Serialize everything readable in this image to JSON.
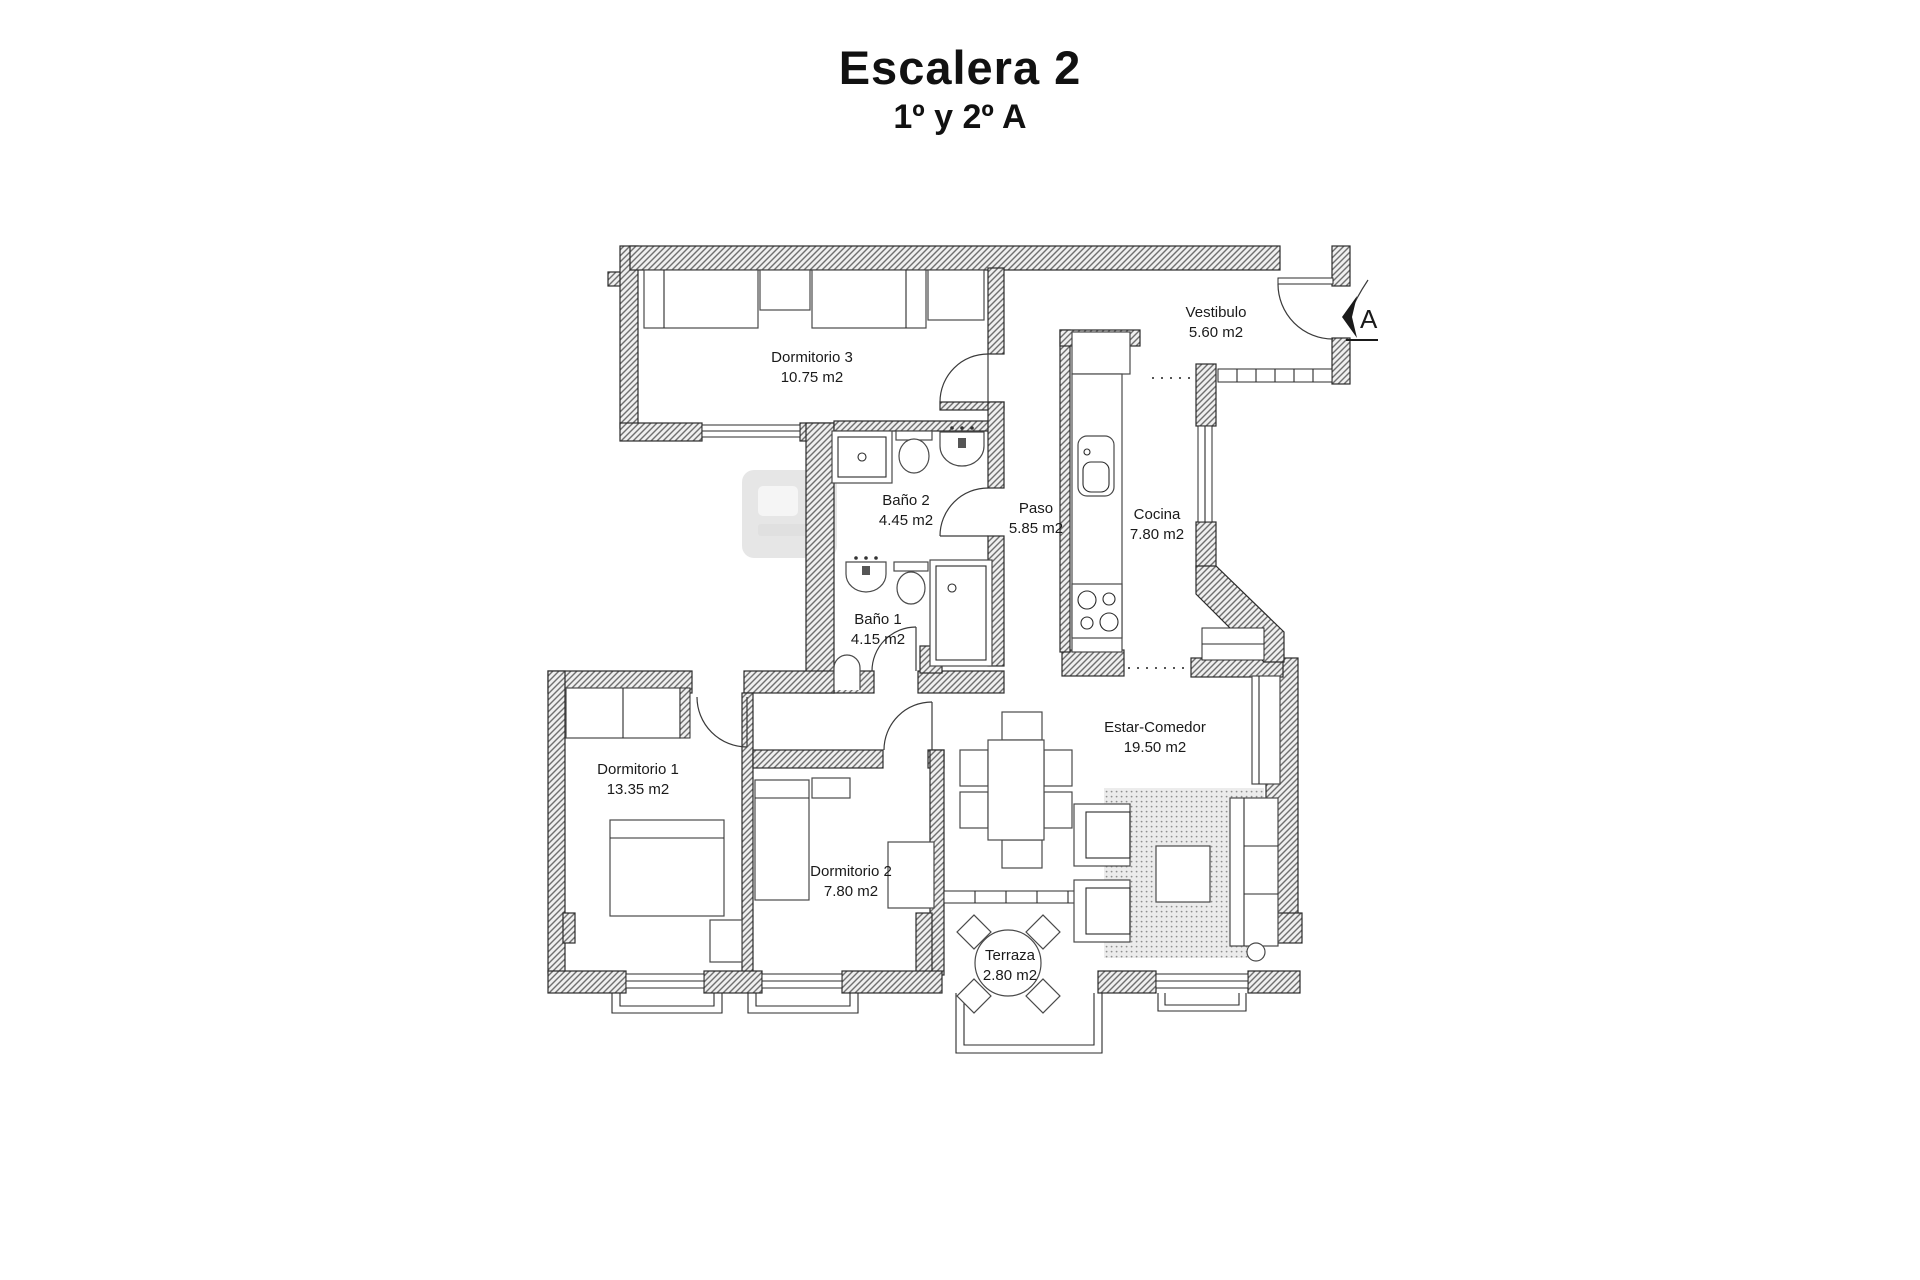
{
  "header": {
    "title": "Escalera 2",
    "subtitle": "1º y 2º A"
  },
  "rooms": [
    {
      "id": "dormitorio-3",
      "name": "Dormitorio 3",
      "area": "10.75 m2"
    },
    {
      "id": "vestibulo",
      "name": "Vestibulo",
      "area": "5.60 m2"
    },
    {
      "id": "bano-2",
      "name": "Baño 2",
      "area": "4.45 m2"
    },
    {
      "id": "paso",
      "name": "Paso",
      "area": "5.85 m2"
    },
    {
      "id": "cocina",
      "name": "Cocina",
      "area": "7.80 m2"
    },
    {
      "id": "bano-1",
      "name": "Baño 1",
      "area": "4.15 m2"
    },
    {
      "id": "dormitorio-1",
      "name": "Dormitorio 1",
      "area": "13.35 m2"
    },
    {
      "id": "dormitorio-2",
      "name": "Dormitorio 2",
      "area": "7.80 m2"
    },
    {
      "id": "estar-comedor",
      "name": "Estar-Comedor",
      "area": "19.50 m2"
    },
    {
      "id": "terraza",
      "name": "Terraza",
      "area": "2.80 m2"
    }
  ],
  "entrance": {
    "label": "A"
  },
  "colors": {
    "wall_hatch": "#6f6f6f",
    "wall_fill": "#f0f0f0",
    "line": "#2b2b2b",
    "text": "#1a1a1a",
    "rug_dot": "#8f8f8f",
    "watermark": "#c9c9c9"
  }
}
